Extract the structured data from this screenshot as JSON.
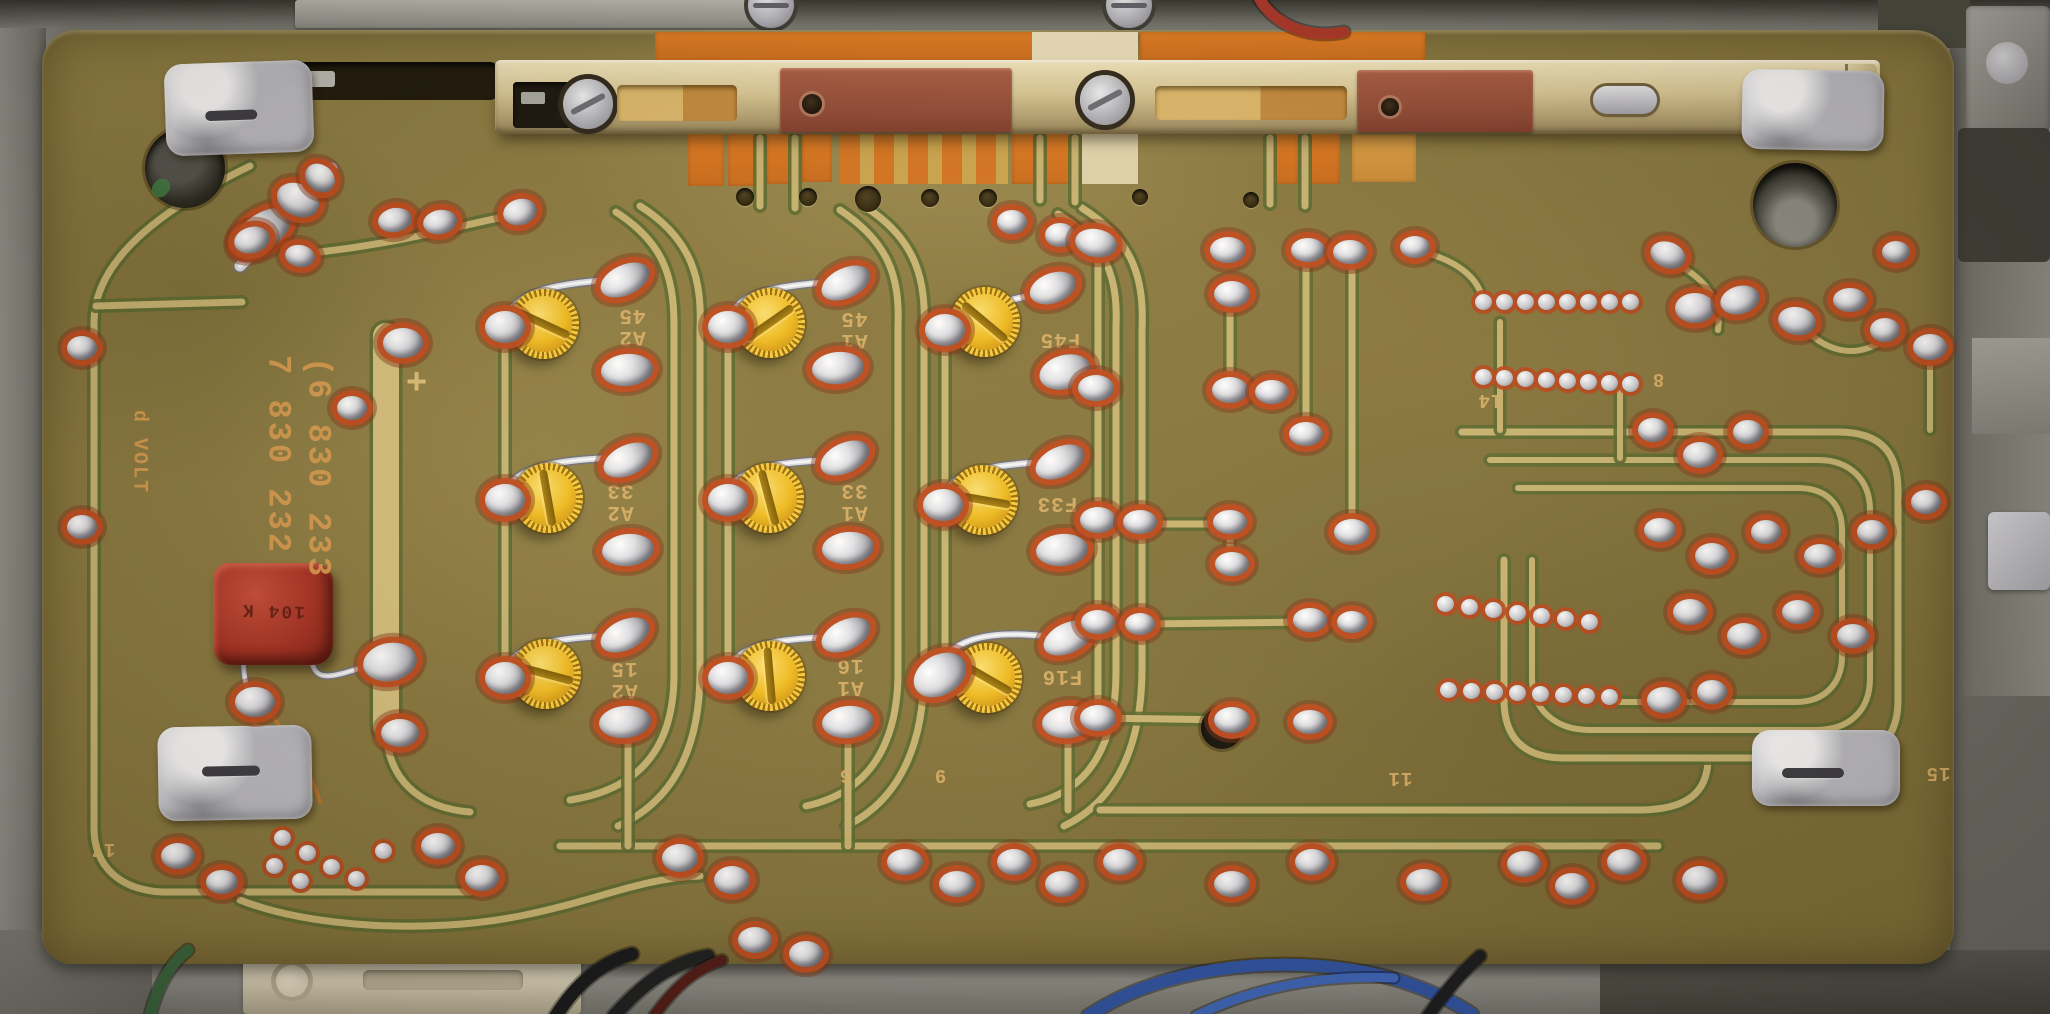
{
  "scene": {
    "description": "Photograph: solder side of a vintage Blaupunkt car-radio printed circuit board in a grey metal chassis, with tuner slide rail at top, nine yellow alignment trimmer screws, a red film capacitor and many solder joints",
    "board_color": "#85743c",
    "trace_color": "#c6b170",
    "trace_edge_color": "#5a682f",
    "pad_ring_color": "#bf4a1c",
    "solder_color": "#d9dade",
    "trimmer_color": "#edb91f",
    "capacitor_color": "#a52f22",
    "silkscreen_color": "#d8ae66"
  },
  "silkscreen": {
    "part_number_1": "7 830 232",
    "part_number_2": "(6 830 233",
    "volt_label": "d VOLT",
    "plus_mark": "+",
    "capacitor_marking": "104 K"
  },
  "trimmers": [
    {
      "x": 544,
      "y": 324,
      "slot": 25,
      "label": [
        "A2",
        "45"
      ],
      "lx": 632,
      "ly": 325
    },
    {
      "x": 770,
      "y": 323,
      "slot": -35,
      "label": [
        "A1",
        "45"
      ],
      "lx": 854,
      "ly": 328
    },
    {
      "x": 985,
      "y": 322,
      "slot": 40,
      "label": [
        "F45"
      ],
      "lx": 1060,
      "ly": 338
    },
    {
      "x": 548,
      "y": 498,
      "slot": 80,
      "label": [
        "A2",
        "33"
      ],
      "lx": 620,
      "ly": 500
    },
    {
      "x": 769,
      "y": 498,
      "slot": 75,
      "label": [
        "A1",
        "33"
      ],
      "lx": 854,
      "ly": 500
    },
    {
      "x": 983,
      "y": 500,
      "slot": 10,
      "label": [
        "F33"
      ],
      "lx": 1057,
      "ly": 502
    },
    {
      "x": 546,
      "y": 674,
      "slot": 15,
      "label": [
        "A2",
        "15"
      ],
      "lx": 624,
      "ly": 678
    },
    {
      "x": 770,
      "y": 676,
      "slot": 85,
      "label": [
        "A1",
        "16"
      ],
      "lx": 850,
      "ly": 675
    },
    {
      "x": 987,
      "y": 678,
      "slot": 30,
      "label": [
        "F16"
      ],
      "lx": 1062,
      "ly": 675
    }
  ],
  "pin_labels": [
    [
      "14",
      1490,
      399
    ],
    [
      "8",
      1658,
      378
    ],
    [
      "17",
      103,
      848
    ],
    [
      "6",
      845,
      774
    ],
    [
      "9",
      940,
      774
    ],
    [
      "11",
      1400,
      777
    ],
    [
      "15",
      1938,
      772
    ]
  ],
  "holes": {
    "small": [
      [
        745,
        197,
        9
      ],
      [
        808,
        197,
        9
      ],
      [
        868,
        199,
        13
      ],
      [
        930,
        198,
        9
      ],
      [
        988,
        198,
        9
      ],
      [
        1140,
        197,
        8
      ],
      [
        1251,
        200,
        8
      ]
    ]
  },
  "pads": [
    [
      165,
      62,
      148,
      92,
      -2,
      [
        40,
        48,
        52
      ]
    ],
    [
      1742,
      70,
      142,
      80,
      1,
      null
    ],
    [
      158,
      726,
      154,
      94,
      -1,
      [
        44,
        40,
        58
      ]
    ],
    [
      1752,
      730,
      148,
      76,
      0,
      [
        30,
        38,
        62
      ]
    ]
  ],
  "solder_joints": [
    [
      262,
      232,
      66,
      36,
      -35
    ],
    [
      298,
      200,
      44,
      32,
      25
    ],
    [
      320,
      178,
      32,
      26,
      40
    ],
    [
      252,
      240,
      36,
      26,
      -15
    ],
    [
      300,
      256,
      30,
      22,
      10
    ],
    [
      352,
      408,
      30,
      24,
      0
    ],
    [
      82,
      348,
      30,
      24,
      0
    ],
    [
      82,
      527,
      30,
      24,
      0
    ],
    [
      395,
      220,
      34,
      24,
      -10
    ],
    [
      440,
      222,
      34,
      24,
      -10
    ],
    [
      520,
      212,
      34,
      26,
      -15
    ],
    [
      403,
      343,
      40,
      30,
      0
    ],
    [
      400,
      733,
      38,
      28,
      0
    ],
    [
      505,
      327,
      40,
      32,
      0
    ],
    [
      625,
      280,
      52,
      30,
      -25
    ],
    [
      627,
      370,
      52,
      32,
      -5
    ],
    [
      728,
      327,
      40,
      32,
      0
    ],
    [
      846,
      283,
      52,
      30,
      -25
    ],
    [
      838,
      368,
      52,
      32,
      -5
    ],
    [
      945,
      330,
      40,
      32,
      0
    ],
    [
      1053,
      288,
      48,
      30,
      -20
    ],
    [
      1065,
      372,
      52,
      34,
      -15
    ],
    [
      505,
      500,
      40,
      32,
      0
    ],
    [
      628,
      460,
      52,
      30,
      -25
    ],
    [
      628,
      550,
      52,
      32,
      -5
    ],
    [
      728,
      500,
      40,
      32,
      0
    ],
    [
      845,
      458,
      52,
      30,
      -25
    ],
    [
      848,
      548,
      52,
      32,
      -5
    ],
    [
      943,
      505,
      40,
      32,
      0
    ],
    [
      1060,
      462,
      52,
      30,
      -25
    ],
    [
      1062,
      550,
      52,
      32,
      -5
    ],
    [
      505,
      678,
      40,
      32,
      0
    ],
    [
      625,
      635,
      52,
      30,
      -25
    ],
    [
      625,
      722,
      52,
      32,
      -5
    ],
    [
      728,
      678,
      40,
      32,
      0
    ],
    [
      846,
      635,
      52,
      30,
      -25
    ],
    [
      848,
      722,
      52,
      32,
      -5
    ],
    [
      940,
      675,
      56,
      40,
      -30
    ],
    [
      1068,
      638,
      52,
      30,
      -25
    ],
    [
      1068,
      722,
      52,
      32,
      -5
    ],
    [
      1012,
      222,
      30,
      24,
      0
    ],
    [
      1060,
      235,
      30,
      24,
      0
    ],
    [
      1096,
      243,
      42,
      28,
      10
    ],
    [
      1228,
      250,
      36,
      26,
      0
    ],
    [
      1232,
      294,
      36,
      26,
      0
    ],
    [
      1308,
      250,
      34,
      24,
      0
    ],
    [
      1350,
      252,
      34,
      24,
      0
    ],
    [
      1415,
      247,
      30,
      22,
      0
    ],
    [
      1096,
      388,
      36,
      26,
      0
    ],
    [
      1230,
      390,
      36,
      26,
      0
    ],
    [
      1272,
      392,
      34,
      24,
      0
    ],
    [
      1306,
      434,
      34,
      24,
      0
    ],
    [
      1098,
      520,
      36,
      26,
      0
    ],
    [
      1140,
      522,
      34,
      24,
      0
    ],
    [
      1230,
      522,
      34,
      24,
      0
    ],
    [
      1232,
      564,
      34,
      24,
      0
    ],
    [
      1352,
      532,
      36,
      26,
      0
    ],
    [
      1098,
      622,
      34,
      24,
      0
    ],
    [
      1140,
      624,
      30,
      22,
      0
    ],
    [
      1310,
      620,
      34,
      24,
      0
    ],
    [
      1352,
      622,
      30,
      22,
      0
    ],
    [
      1098,
      718,
      36,
      26,
      0
    ],
    [
      1232,
      720,
      36,
      26,
      0
    ],
    [
      1310,
      722,
      34,
      24,
      0
    ],
    [
      1668,
      255,
      36,
      26,
      20
    ],
    [
      1695,
      308,
      40,
      30,
      0
    ],
    [
      1740,
      300,
      40,
      28,
      -15
    ],
    [
      1797,
      321,
      38,
      28,
      10
    ],
    [
      1850,
      300,
      34,
      24,
      0
    ],
    [
      1885,
      330,
      30,
      24,
      0
    ],
    [
      1930,
      347,
      34,
      26,
      0
    ],
    [
      1896,
      252,
      28,
      22,
      0
    ],
    [
      1653,
      430,
      30,
      24,
      0
    ],
    [
      1700,
      455,
      34,
      26,
      0
    ],
    [
      1748,
      432,
      30,
      24,
      0
    ],
    [
      1660,
      530,
      32,
      24,
      0
    ],
    [
      1712,
      556,
      34,
      26,
      0
    ],
    [
      1766,
      532,
      30,
      24,
      0
    ],
    [
      1820,
      556,
      32,
      24,
      0
    ],
    [
      1872,
      532,
      30,
      24,
      0
    ],
    [
      1926,
      502,
      30,
      24,
      0
    ],
    [
      1690,
      612,
      34,
      26,
      0
    ],
    [
      1744,
      636,
      34,
      26,
      0
    ],
    [
      1798,
      612,
      32,
      24,
      0
    ],
    [
      1853,
      636,
      32,
      24,
      0
    ],
    [
      1664,
      700,
      34,
      26,
      0
    ],
    [
      1712,
      692,
      30,
      24,
      0
    ],
    [
      680,
      858,
      36,
      28,
      0
    ],
    [
      732,
      880,
      36,
      28,
      0
    ],
    [
      905,
      862,
      36,
      26,
      0
    ],
    [
      957,
      884,
      36,
      26,
      0
    ],
    [
      1014,
      862,
      34,
      26,
      0
    ],
    [
      1062,
      884,
      34,
      26,
      0
    ],
    [
      1120,
      862,
      34,
      26,
      0
    ],
    [
      1232,
      884,
      36,
      26,
      0
    ],
    [
      1312,
      862,
      34,
      26,
      0
    ],
    [
      1424,
      882,
      36,
      26,
      0
    ],
    [
      1524,
      864,
      34,
      26,
      0
    ],
    [
      1572,
      886,
      34,
      26,
      0
    ],
    [
      1624,
      862,
      34,
      26,
      0
    ],
    [
      1700,
      880,
      36,
      28,
      0
    ],
    [
      755,
      940,
      34,
      26,
      0
    ],
    [
      806,
      954,
      34,
      26,
      0
    ],
    [
      178,
      856,
      34,
      26,
      0
    ],
    [
      222,
      882,
      32,
      24,
      0
    ],
    [
      438,
      846,
      34,
      26,
      0
    ],
    [
      482,
      878,
      34,
      26,
      0
    ],
    [
      255,
      702,
      40,
      30,
      0
    ],
    [
      390,
      662,
      54,
      38,
      -10
    ]
  ],
  "solder_beads": {
    "rows": [
      {
        "x": 1483,
        "y": 302,
        "dx": 21,
        "dy": 0,
        "n": 8
      },
      {
        "x": 1483,
        "y": 377,
        "dx": 21,
        "dy": 1,
        "n": 8
      },
      {
        "x": 1445,
        "y": 604,
        "dx": 24,
        "dy": 3,
        "n": 7
      },
      {
        "x": 1448,
        "y": 690,
        "dx": 23,
        "dy": 1,
        "n": 8
      }
    ],
    "cluster": [
      [
        282,
        838
      ],
      [
        307,
        853
      ],
      [
        331,
        867
      ],
      [
        356,
        879
      ],
      [
        300,
        881
      ],
      [
        274,
        866
      ],
      [
        383,
        851
      ]
    ]
  },
  "traces": [
    {
      "d": "M250,166 C170,205 96,255 94,320 L94,828 C94,868 122,890 162,892 L470,892",
      "w": 7
    },
    {
      "d": "M96,306 L242,302",
      "w": 7
    },
    {
      "d": "M386,336 L386,726",
      "w": 26,
      "c": "#d2bd7c"
    },
    {
      "d": "M386,726 C386,780 420,808 470,812",
      "w": 7
    },
    {
      "d": "M616,212 C662,242 674,274 674,326 L674,674 C674,738 648,788 570,800",
      "w": 7
    },
    {
      "d": "M640,206 C694,240 702,282 700,330 L700,672 C700,744 676,800 618,826",
      "w": 7
    },
    {
      "d": "M840,210 C888,242 900,276 898,326 L898,672 C898,740 872,792 806,806",
      "w": 7
    },
    {
      "d": "M864,206 C918,240 926,282 924,330 L924,670 C924,744 900,800 846,826",
      "w": 7
    },
    {
      "d": "M1058,214 C1106,244 1118,276 1116,326 L1116,672 C1116,740 1092,792 1030,804",
      "w": 7
    },
    {
      "d": "M1082,208 C1136,242 1144,282 1142,330 L1142,668 C1142,744 1118,800 1064,826",
      "w": 7
    },
    {
      "d": "M760,138 L760,206",
      "w": 7
    },
    {
      "d": "M795,138 L795,208",
      "w": 7
    },
    {
      "d": "M1040,138 L1040,200",
      "w": 7
    },
    {
      "d": "M1075,138 L1075,202",
      "w": 7
    },
    {
      "d": "M1270,138 L1270,204",
      "w": 7
    },
    {
      "d": "M1305,138 L1305,206",
      "w": 7
    },
    {
      "d": "M1098,250 L1098,718",
      "w": 7
    },
    {
      "d": "M1306,252 L1306,432",
      "w": 7
    },
    {
      "d": "M1352,254 L1352,530",
      "w": 7
    },
    {
      "d": "M1230,296 L1230,388",
      "w": 7
    },
    {
      "d": "M1230,524 L1230,562",
      "w": 7
    },
    {
      "d": "M1140,524 L1228,524",
      "w": 7
    },
    {
      "d": "M1140,624 L1308,622",
      "w": 7
    },
    {
      "d": "M1098,718 L1230,720",
      "w": 7
    },
    {
      "d": "M560,846 L1658,846",
      "w": 7
    },
    {
      "d": "M1100,810 L1638,810 C1688,810 1708,792 1708,758",
      "w": 7
    },
    {
      "d": "M240,900 C310,928 430,934 520,916 C600,900 640,878 700,876",
      "w": 7
    },
    {
      "d": "M1462,432 L1838,432 C1880,432 1898,452 1898,490 L1898,700 C1898,738 1878,758 1840,758 L1564,758 C1524,758 1504,738 1504,700 L1504,560",
      "w": 7
    },
    {
      "d": "M1490,460 L1818,460 C1850,460 1870,480 1870,510 L1870,678 C1870,712 1848,730 1816,730 L1590,730 C1556,730 1532,710 1532,678 L1532,560",
      "w": 6
    },
    {
      "d": "M1518,488 L1798,488 C1826,488 1842,504 1842,530 L1842,656 C1842,684 1824,702 1796,702 L1618,702",
      "w": 6
    },
    {
      "d": "M628,734 L628,846",
      "w": 7
    },
    {
      "d": "M848,734 L848,846",
      "w": 7
    },
    {
      "d": "M1068,734 L1068,810",
      "w": 7
    },
    {
      "d": "M1500,322 L1500,430",
      "w": 6
    },
    {
      "d": "M1620,390 L1620,458",
      "w": 6
    },
    {
      "d": "M320,252 C420,240 470,222 520,214",
      "w": 7
    },
    {
      "d": "M505,334 L505,672",
      "w": 7
    },
    {
      "d": "M728,334 L728,672",
      "w": 7
    },
    {
      "d": "M945,336 L945,670",
      "w": 7
    },
    {
      "d": "M1660,258 C1704,272 1722,300 1718,330",
      "w": 6
    },
    {
      "d": "M1798,322 C1824,352 1854,360 1884,340",
      "w": 6
    },
    {
      "d": "M1930,350 L1930,430",
      "w": 6
    },
    {
      "d": "M1415,250 C1460,260 1480,280 1483,302",
      "w": 6
    }
  ],
  "wires": {
    "silver": [
      {
        "d": "M505,322 C512,294 548,284 610,280",
        "w": 6
      },
      {
        "d": "M728,322 C735,294 770,286 832,282",
        "w": 6
      },
      {
        "d": "M1053,292 C1002,298 964,316 950,328",
        "w": 6
      },
      {
        "d": "M505,494 C512,470 548,460 612,458",
        "w": 6
      },
      {
        "d": "M728,494 C735,470 770,462 833,460",
        "w": 6
      },
      {
        "d": "M943,498 C950,473 985,465 1046,462",
        "w": 6
      },
      {
        "d": "M505,672 C512,647 548,638 610,636",
        "w": 6
      },
      {
        "d": "M728,672 C735,647 770,639 832,637",
        "w": 6
      },
      {
        "d": "M940,668 C950,640 986,630 1044,636",
        "w": 6
      },
      {
        "d": "M240,266 C262,244 294,208 320,184 L332,168",
        "w": 11
      },
      {
        "d": "M243,660 C245,688 248,694 252,698",
        "w": 5
      },
      {
        "d": "M312,662 C316,684 336,676 372,664",
        "w": 5
      }
    ],
    "orange": [
      "M242,706 C282,758 295,782 302,806",
      "M262,702 C300,752 313,778 320,802"
    ],
    "chassis": [
      {
        "d": "M150,1016 C158,984 172,962 188,950",
        "color": "#35603a",
        "w": 11
      },
      {
        "d": "M556,1016 C576,984 602,962 632,954",
        "color": "#141518",
        "w": 13
      },
      {
        "d": "M614,1016 C642,984 672,962 708,956",
        "color": "#1a1b1e",
        "w": 13
      },
      {
        "d": "M654,1016 C674,988 694,970 722,960",
        "color": "#4e1713",
        "w": 10
      },
      {
        "d": "M1088,1016 C1150,974 1242,960 1320,966 C1392,972 1442,994 1472,1014",
        "color": "#2b4fa0",
        "w": 12
      },
      {
        "d": "M1196,1016 C1252,988 1322,974 1394,978",
        "color": "#3a62b8",
        "w": 9
      },
      {
        "d": "M1428,1016 C1448,988 1464,970 1480,956",
        "color": "#17181b",
        "w": 12
      },
      {
        "d": "M1258,-4 C1270,20 1302,40 1344,32",
        "color": "#a93326",
        "w": 11
      }
    ]
  }
}
